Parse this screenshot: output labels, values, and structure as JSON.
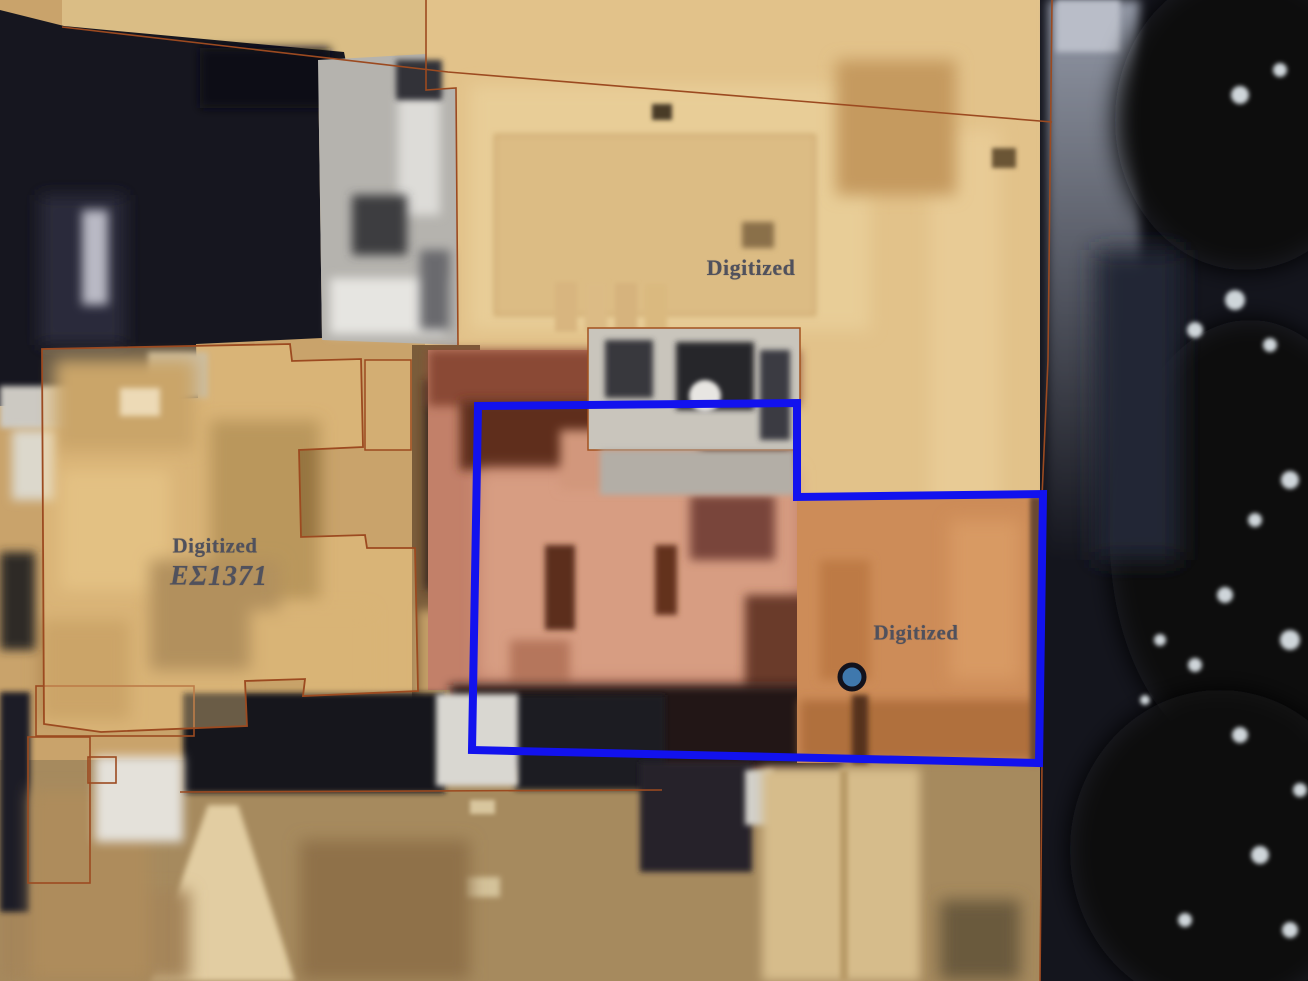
{
  "parcels": {
    "top": {
      "label": "Digitized"
    },
    "left": {
      "label": "Digitized",
      "id": "ΕΣ1371"
    },
    "right": {
      "label": "Digitized"
    }
  },
  "colors": {
    "selection_outline_blue": "#1212ee",
    "marker_fill": "#3f78ad",
    "marker_ring": "#12121c",
    "parcel_boundary_brown": "#9c4a20",
    "parcel_overlay_tan": "#e2c28a",
    "left_parcel_fill": "rgba(244,208,140,0.38)",
    "center_building_salmon": "#c28069",
    "right_parcel_orange": "#cd8c58",
    "label_text": "#50515d"
  }
}
